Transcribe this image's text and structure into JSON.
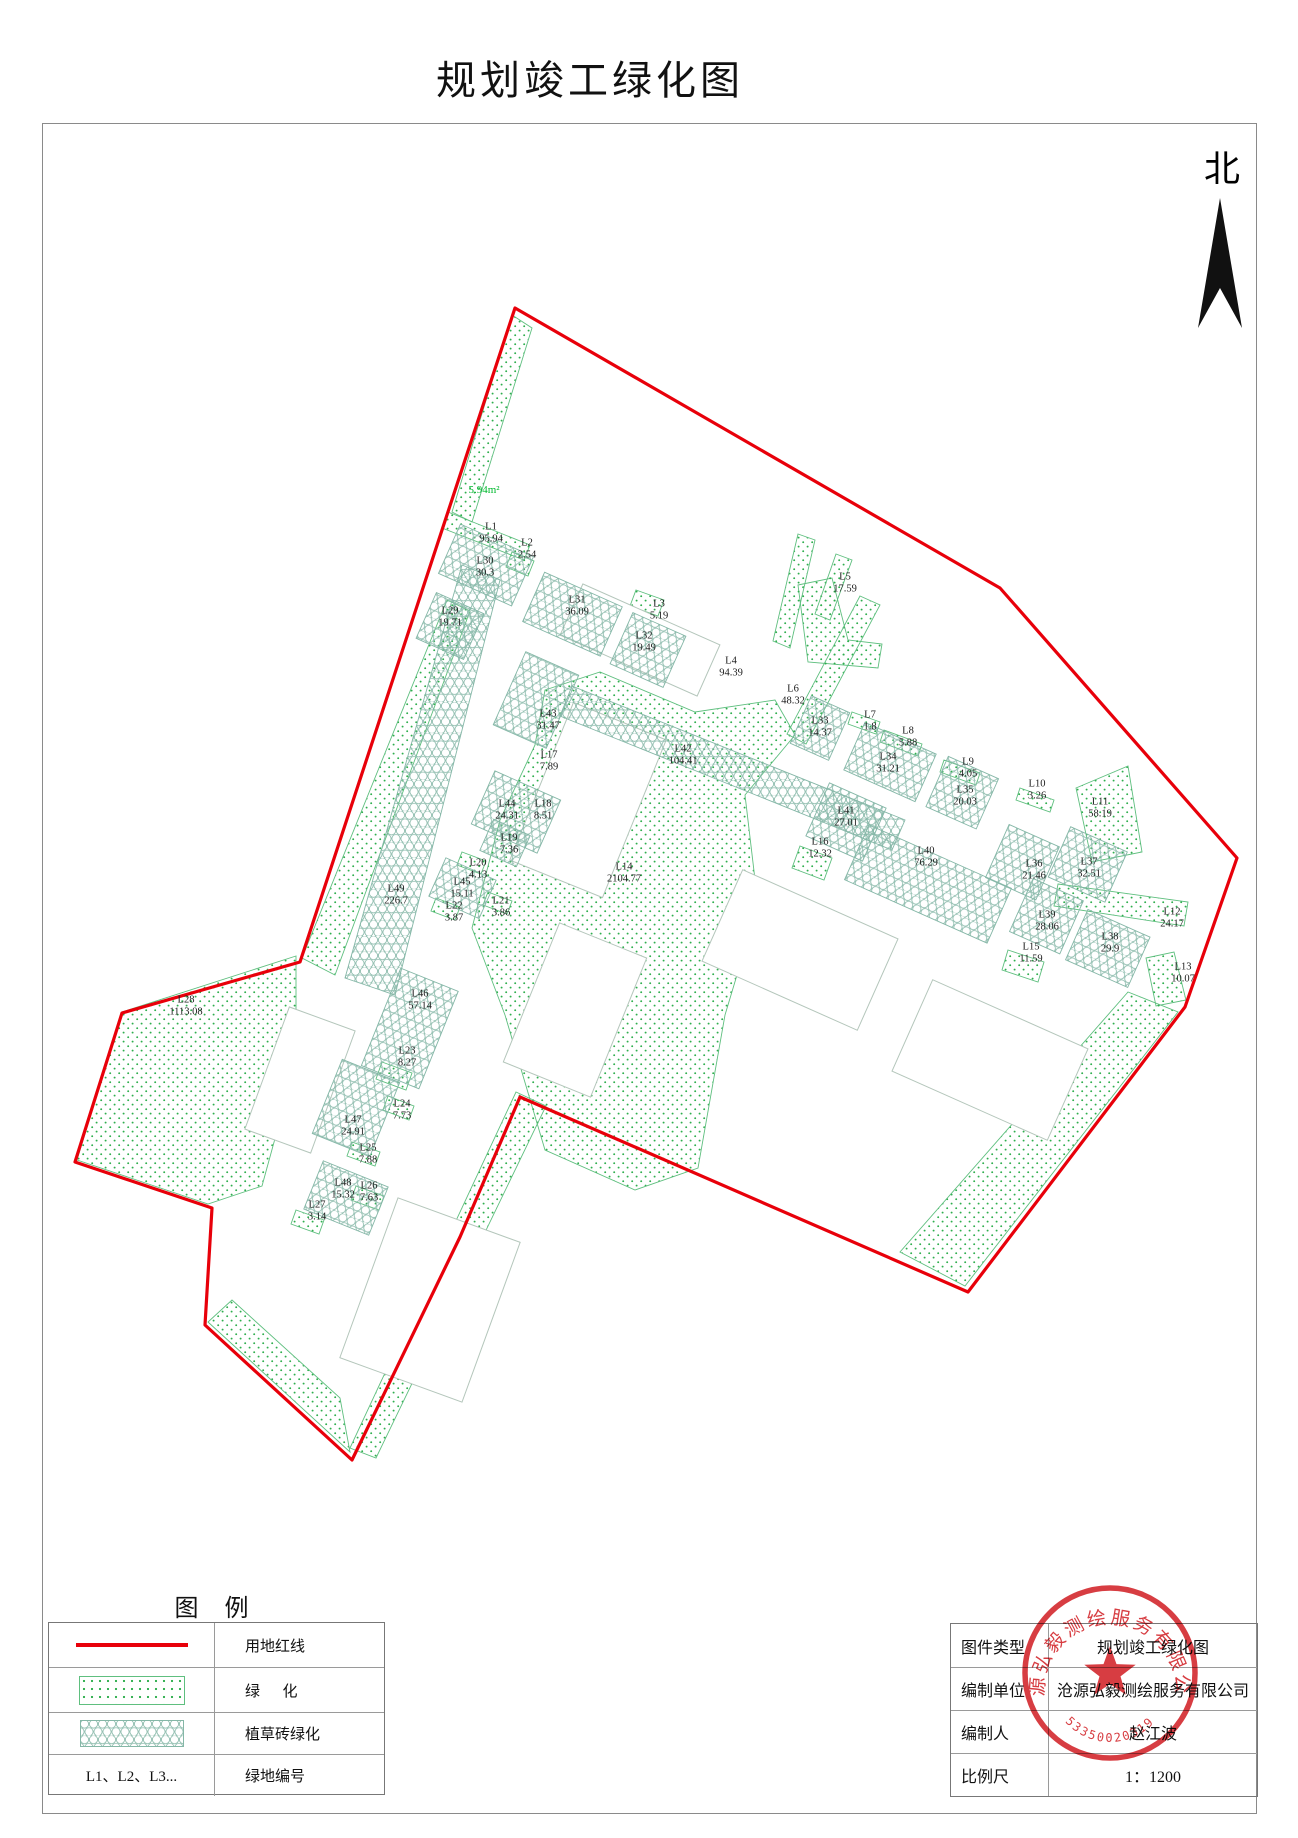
{
  "title": "规划竣工绿化图",
  "north_label": "北",
  "map": {
    "green_note": "5.94m²",
    "labels": [
      {
        "id": "L1",
        "area": "95.94",
        "x": 491,
        "y": 533
      },
      {
        "id": "L2",
        "area": "2.54",
        "x": 527,
        "y": 549
      },
      {
        "id": "L3",
        "area": "5.19",
        "x": 659,
        "y": 610
      },
      {
        "id": "L4",
        "area": "94.39",
        "x": 731,
        "y": 667
      },
      {
        "id": "L5",
        "area": "17.59",
        "x": 845,
        "y": 583
      },
      {
        "id": "L6",
        "area": "48.32",
        "x": 793,
        "y": 695
      },
      {
        "id": "L7",
        "area": "1.8",
        "x": 870,
        "y": 721
      },
      {
        "id": "L8",
        "area": "5.88",
        "x": 908,
        "y": 737
      },
      {
        "id": "L9",
        "area": "4.05",
        "x": 968,
        "y": 768
      },
      {
        "id": "L10",
        "area": "3.26",
        "x": 1037,
        "y": 790
      },
      {
        "id": "L11",
        "area": "58.19",
        "x": 1100,
        "y": 808
      },
      {
        "id": "L12",
        "area": "24.17",
        "x": 1172,
        "y": 918
      },
      {
        "id": "L13",
        "area": "10.07",
        "x": 1183,
        "y": 973
      },
      {
        "id": "L14",
        "area": "2104.77",
        "x": 624,
        "y": 873
      },
      {
        "id": "L15",
        "area": "11.59",
        "x": 1031,
        "y": 953
      },
      {
        "id": "L16",
        "area": "12.32",
        "x": 820,
        "y": 848
      },
      {
        "id": "L17",
        "area": "7.89",
        "x": 549,
        "y": 761
      },
      {
        "id": "L18",
        "area": "8.51",
        "x": 543,
        "y": 810
      },
      {
        "id": "L19",
        "area": "7.36",
        "x": 509,
        "y": 844
      },
      {
        "id": "L20",
        "area": "4.13",
        "x": 478,
        "y": 869
      },
      {
        "id": "L21",
        "area": "3.86",
        "x": 501,
        "y": 907
      },
      {
        "id": "L22",
        "area": "3.87",
        "x": 454,
        "y": 912
      },
      {
        "id": "L23",
        "area": "8.27",
        "x": 407,
        "y": 1057
      },
      {
        "id": "L24",
        "area": "7.73",
        "x": 402,
        "y": 1110
      },
      {
        "id": "L25",
        "area": "7.88",
        "x": 368,
        "y": 1154
      },
      {
        "id": "L26",
        "area": "7.63",
        "x": 369,
        "y": 1192
      },
      {
        "id": "L27",
        "area": "3.14",
        "x": 317,
        "y": 1211
      },
      {
        "id": "L28",
        "area": "1113.08",
        "x": 186,
        "y": 1006
      },
      {
        "id": "L29",
        "area": "19.71",
        "x": 450,
        "y": 617
      },
      {
        "id": "L30",
        "area": "30.3",
        "x": 485,
        "y": 567
      },
      {
        "id": "L31",
        "area": "36.09",
        "x": 577,
        "y": 606
      },
      {
        "id": "L32",
        "area": "19.49",
        "x": 644,
        "y": 642
      },
      {
        "id": "L33",
        "area": "14.37",
        "x": 820,
        "y": 727
      },
      {
        "id": "L34",
        "area": "31.21",
        "x": 888,
        "y": 763
      },
      {
        "id": "L35",
        "area": "20.03",
        "x": 965,
        "y": 796
      },
      {
        "id": "L36",
        "area": "21.46",
        "x": 1034,
        "y": 870
      },
      {
        "id": "L37",
        "area": "32.51",
        "x": 1089,
        "y": 868
      },
      {
        "id": "L38",
        "area": "29.9",
        "x": 1110,
        "y": 943
      },
      {
        "id": "L39",
        "area": "28.06",
        "x": 1047,
        "y": 921
      },
      {
        "id": "L40",
        "area": "76.29",
        "x": 926,
        "y": 857
      },
      {
        "id": "L41",
        "area": "27.01",
        "x": 846,
        "y": 817
      },
      {
        "id": "L42",
        "area": "104.41",
        "x": 683,
        "y": 755
      },
      {
        "id": "L43",
        "area": "31.47",
        "x": 548,
        "y": 720
      },
      {
        "id": "L44",
        "area": "24.31",
        "x": 507,
        "y": 810
      },
      {
        "id": "L45",
        "area": "15.11",
        "x": 462,
        "y": 888
      },
      {
        "id": "L46",
        "area": "57.14",
        "x": 420,
        "y": 1000
      },
      {
        "id": "L47",
        "area": "24.91",
        "x": 353,
        "y": 1126
      },
      {
        "id": "L48",
        "area": "15.32",
        "x": 343,
        "y": 1189
      },
      {
        "id": "L49",
        "area": "226.7",
        "x": 396,
        "y": 895
      }
    ]
  },
  "legend": {
    "title": "图  例",
    "rows": [
      {
        "symbol": "red-line",
        "label": "用地红线"
      },
      {
        "symbol": "dots",
        "label": "绿      化"
      },
      {
        "symbol": "hex",
        "label": "植草砖绿化"
      },
      {
        "symbol": "L1、L2、L3...",
        "label": "绿地编号"
      }
    ]
  },
  "info_table": {
    "rows": [
      {
        "label": "图件类型",
        "value": "规划竣工绿化图"
      },
      {
        "label": "编制单位",
        "value": "沧源弘毅测绘服务有限公司"
      },
      {
        "label": "编制人",
        "value": "赵江波"
      },
      {
        "label": "比例尺",
        "value": "1：1200"
      }
    ]
  },
  "stamp": {
    "company": "沧源弘毅测绘服务有限公司",
    "number": "53350020319"
  },
  "colors": {
    "boundary_red": "#e8000a",
    "green_dot": "#2fae4e",
    "green_edge": "#5fbf7f",
    "hex_line": "#85b7a7",
    "stamp_red": "#d3282d",
    "note_green": "#00b92e"
  }
}
